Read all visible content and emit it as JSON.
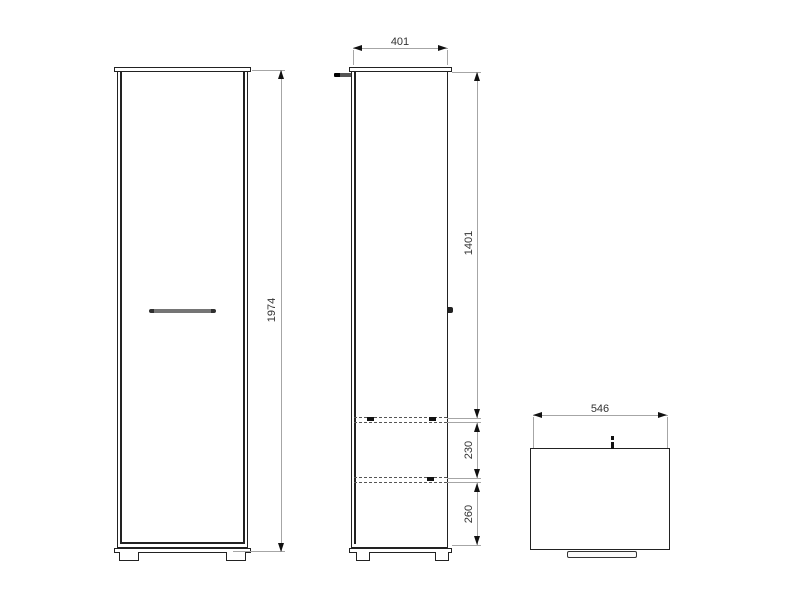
{
  "drawing": {
    "front_view": {
      "height_dim_label": "1974"
    },
    "side_view": {
      "width_dim_label": "401",
      "upper_dim_label": "1401",
      "middle_dim_label": "230",
      "lower_dim_label": "260"
    },
    "top_view": {
      "width_dim_label": "546"
    },
    "colors": {
      "object_line": "#222222",
      "dimension_line": "#a6a6a6",
      "arrow": "#111111",
      "label_text": "#333333",
      "handle_fill": "#6e6e6e",
      "background": "#ffffff"
    }
  }
}
